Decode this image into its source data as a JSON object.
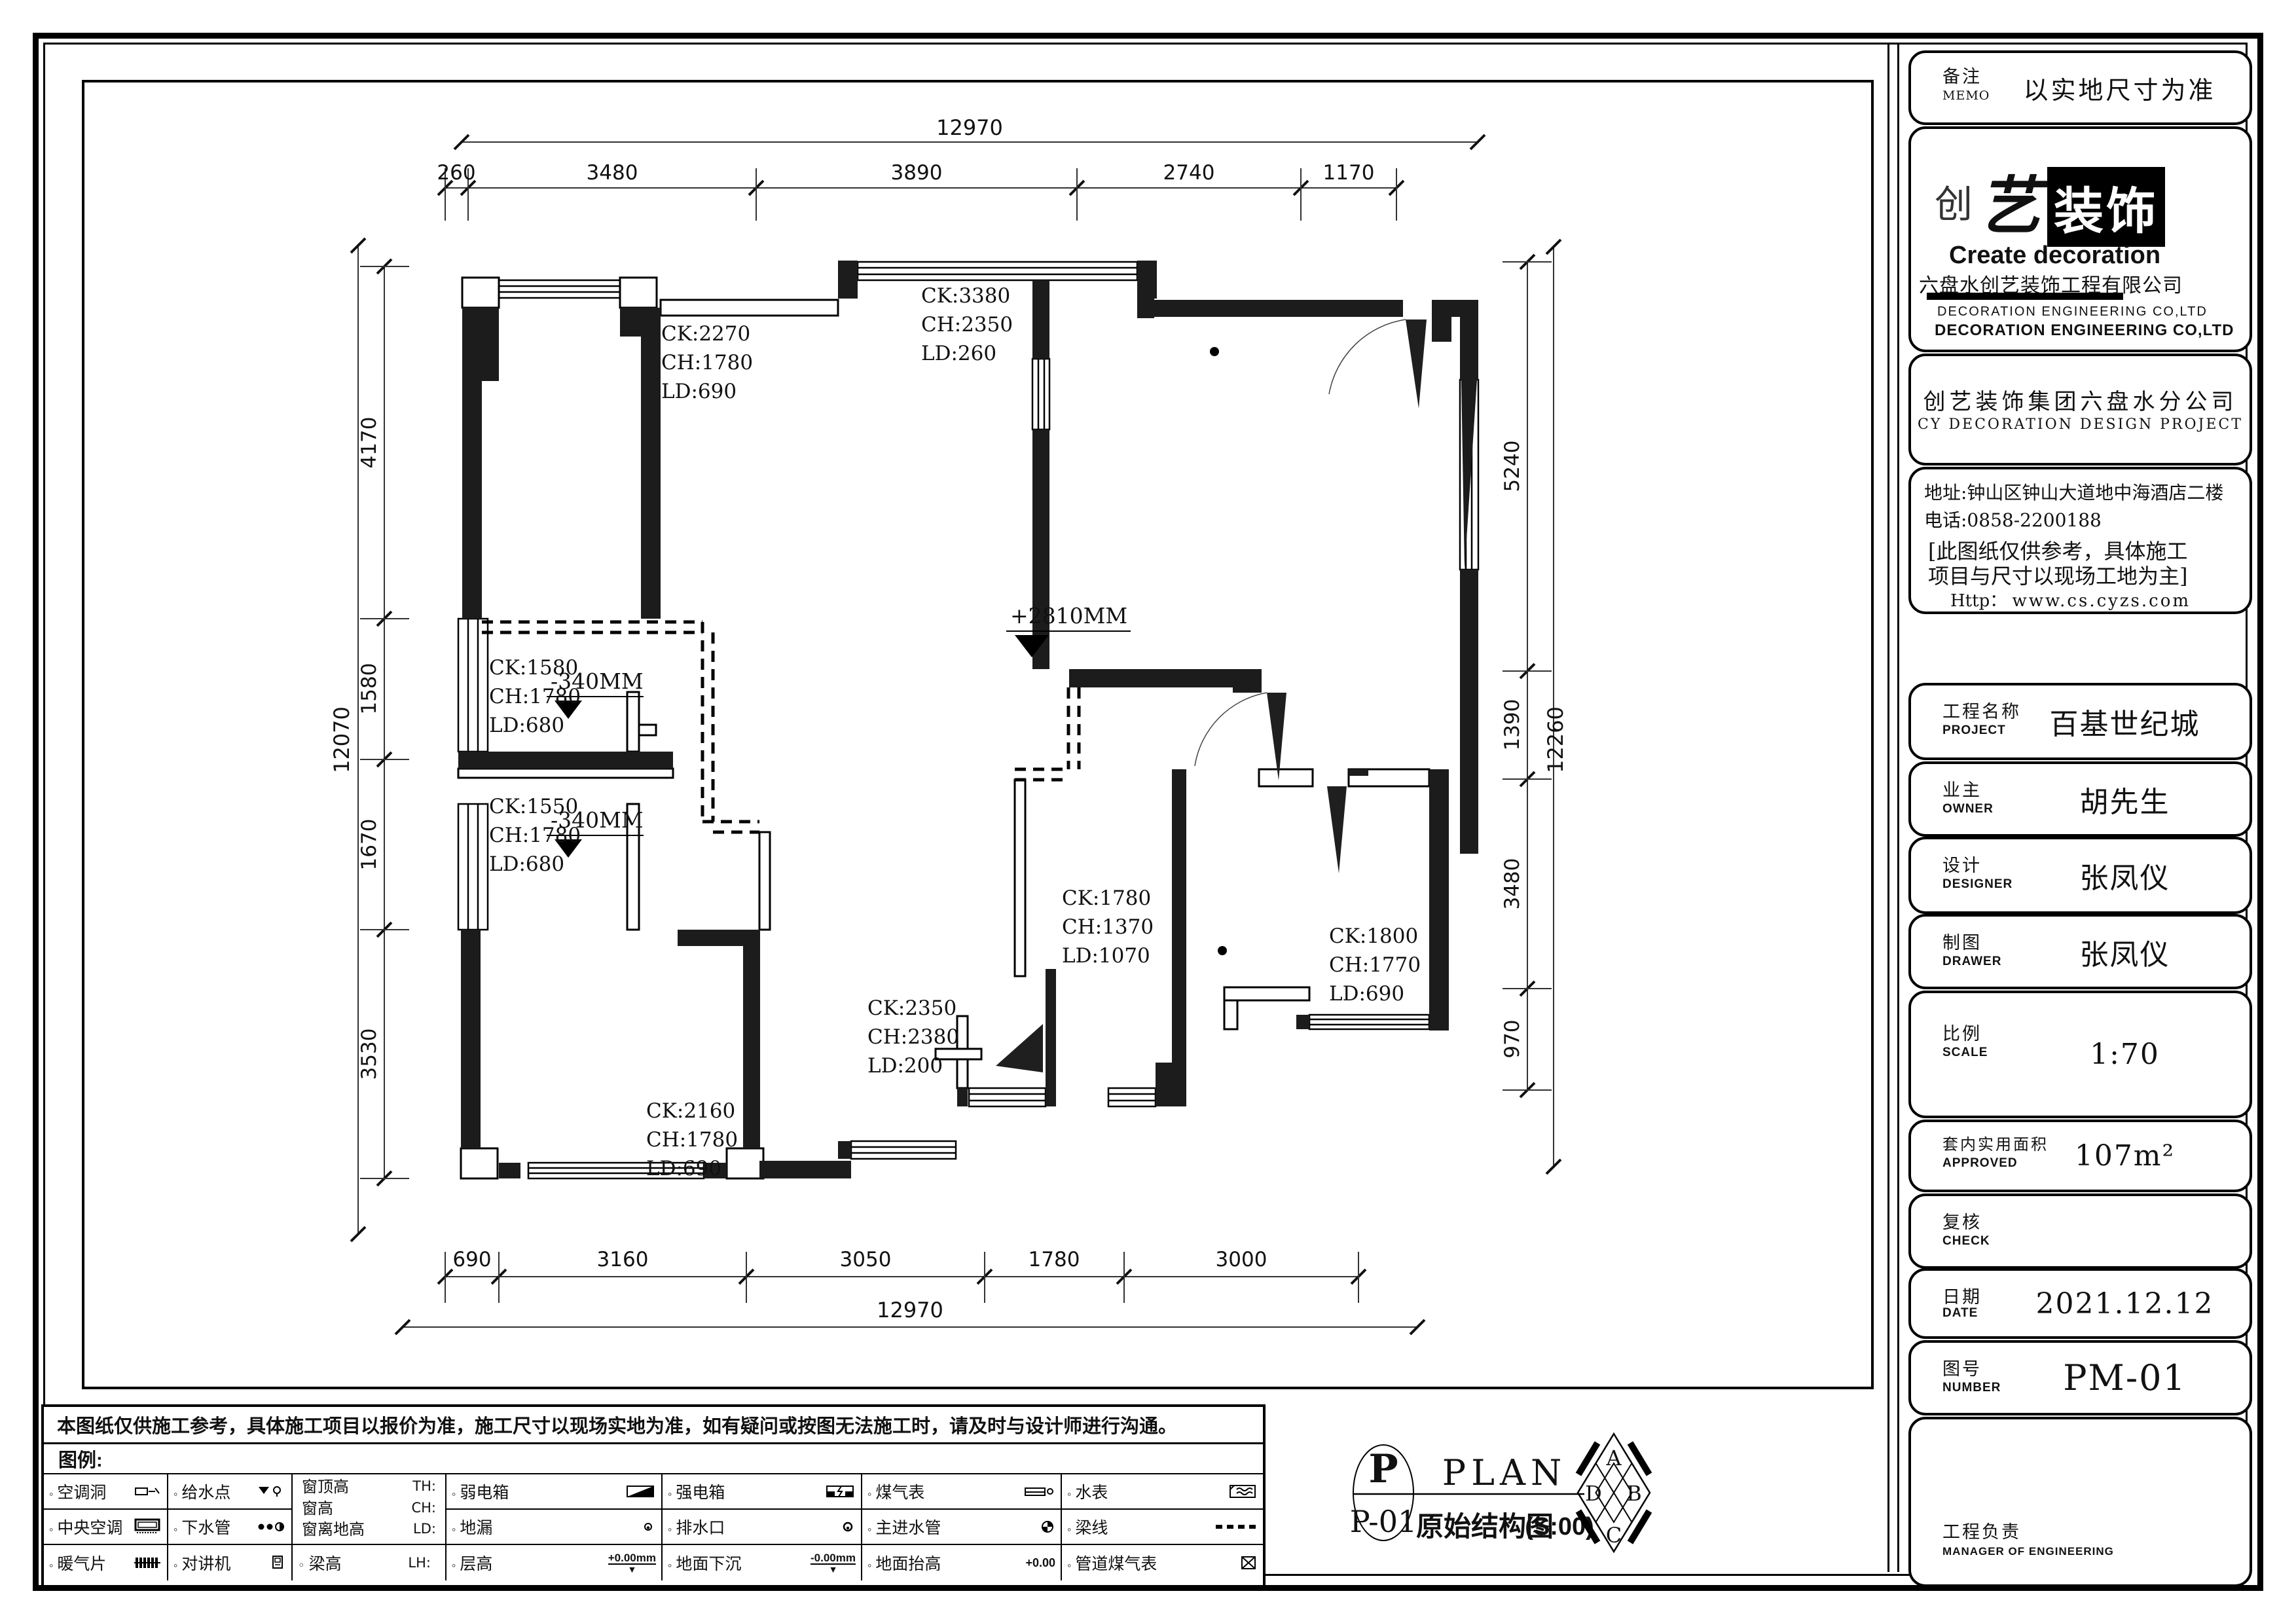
{
  "memo": {
    "label_cn": "备注",
    "label_en": "MEMO",
    "value": "以实地尺寸为准"
  },
  "logo": {
    "chuang": "创",
    "yi": "艺",
    "zhuangshi": "装饰",
    "en": "Create decoration",
    "company": "六盘水创艺装饰工程有限公司",
    "eng_co_light": "DECORATION ENGINEERING CO,LTD",
    "eng_co_bold": "DECORATION ENGINEERING CO,LTD"
  },
  "branch": {
    "cn": "创艺装饰集团六盘水分公司",
    "en": "CY DECORATION DESIGN PROJECT"
  },
  "contact": {
    "address": "地址:钟山区钟山大道地中海酒店二楼",
    "phone": "电话:0858-2200188",
    "note1": "[此图纸仅供参考，具体施工",
    "note2": "项目与尺寸以现场工地为主]",
    "http_label": "Http：",
    "url": "www.cs.cyzs.com"
  },
  "fields": [
    {
      "label_cn": "工程名称",
      "label_en": "PROJECT",
      "value": "百基世纪城"
    },
    {
      "label_cn": "业主",
      "label_en": "OWNER",
      "value": "胡先生"
    },
    {
      "label_cn": "设计",
      "label_en": "DESIGNER",
      "value": "张凤仪"
    },
    {
      "label_cn": "制图",
      "label_en": "DRAWER",
      "value": "张凤仪"
    },
    {
      "label_cn": "比例",
      "label_en": "SCALE",
      "value": "1:70"
    },
    {
      "label_cn": "套内实用面积",
      "label_en": "APPROVED",
      "value": "107m²"
    },
    {
      "label_cn": "复核",
      "label_en": "CHECK",
      "value": ""
    },
    {
      "label_cn": "日期",
      "label_en": "DATE",
      "value": "2021.12.12"
    },
    {
      "label_cn": "图号",
      "label_en": "NUMBER",
      "value": "PM-01"
    },
    {
      "label_cn": "工程负责",
      "label_en": "MANAGER OF ENGINEERING",
      "value": ""
    }
  ],
  "disclaimer": "本图纸仅供施工参考，具体施工项目以报价为准，施工尺寸以现场实地为准，如有疑问或按图无法施工时，请及时与设计师进行沟通。",
  "legend": {
    "title": "图例:",
    "col1": [
      {
        "label": "空调洞"
      },
      {
        "label": "中央空调"
      },
      {
        "label": "暖气片"
      }
    ],
    "col2": [
      {
        "label": "给水点"
      },
      {
        "label": "下水管"
      },
      {
        "label": "对讲机"
      }
    ],
    "col3": {
      "rows": [
        {
          "label": "窗顶高",
          "abbr": "TH:"
        },
        {
          "label": "窗高",
          "abbr": "CH:"
        },
        {
          "label": "窗离地高",
          "abbr": "LD:"
        }
      ],
      "beam": {
        "label": "梁高",
        "abbr": "LH:"
      }
    },
    "col4": [
      {
        "label": "弱电箱"
      },
      {
        "label": "地漏"
      },
      {
        "label": "层高",
        "note": "+0.00mm"
      }
    ],
    "col5": [
      {
        "label": "强电箱"
      },
      {
        "label": "排水口"
      },
      {
        "label": "地面下沉",
        "note": "-0.00mm"
      }
    ],
    "col6": [
      {
        "label": "煤气表"
      },
      {
        "label": "主进水管"
      },
      {
        "label": "地面抬高",
        "note": "+0.00"
      }
    ],
    "col7": [
      {
        "label": "水表"
      },
      {
        "label": "梁线"
      },
      {
        "label": "管道煤气表"
      }
    ]
  },
  "plan_title": {
    "p": "P",
    "p01": "P-01",
    "en": "PLAN",
    "cn": "原始结构图",
    "scale": "(S:00)",
    "dirs": [
      "A",
      "B",
      "C",
      "D"
    ]
  },
  "plan": {
    "dims_top": {
      "total": "12970",
      "segments": [
        "260",
        "3480",
        "3890",
        "2740",
        "1170"
      ]
    },
    "dims_bottom": {
      "total": "12970",
      "segments": [
        "690",
        "3160",
        "3050",
        "1780",
        "3000"
      ]
    },
    "dims_left": {
      "total": "12070",
      "segments": [
        "4170",
        "1580",
        "1670",
        "3530"
      ]
    },
    "dims_right": {
      "total": "12260",
      "segments": [
        "5240",
        "1390",
        "3480",
        "970"
      ]
    },
    "levels": {
      "center": "+2810MM",
      "upper_balcony": "-340MM",
      "lower_balcony": "-340MM"
    },
    "windows": [
      {
        "ck": "CK:2270",
        "ch": "CH:1780",
        "ld": "LD:690"
      },
      {
        "ck": "CK:3380",
        "ch": "CH:2350",
        "ld": "LD:260"
      },
      {
        "ck": "CK:1580",
        "ch": "CH:1780",
        "ld": "LD:680"
      },
      {
        "ck": "CK:1550",
        "ch": "CH:1780",
        "ld": "LD:680"
      },
      {
        "ck": "CK:2160",
        "ch": "CH:1780",
        "ld": "LD:690"
      },
      {
        "ck": "CK:2350",
        "ch": "CH:2380",
        "ld": "LD:200"
      },
      {
        "ck": "CK:1780",
        "ch": "CH:1370",
        "ld": "LD:1070"
      },
      {
        "ck": "CK:1800",
        "ch": "CH:1770",
        "ld": "LD:690"
      }
    ]
  }
}
